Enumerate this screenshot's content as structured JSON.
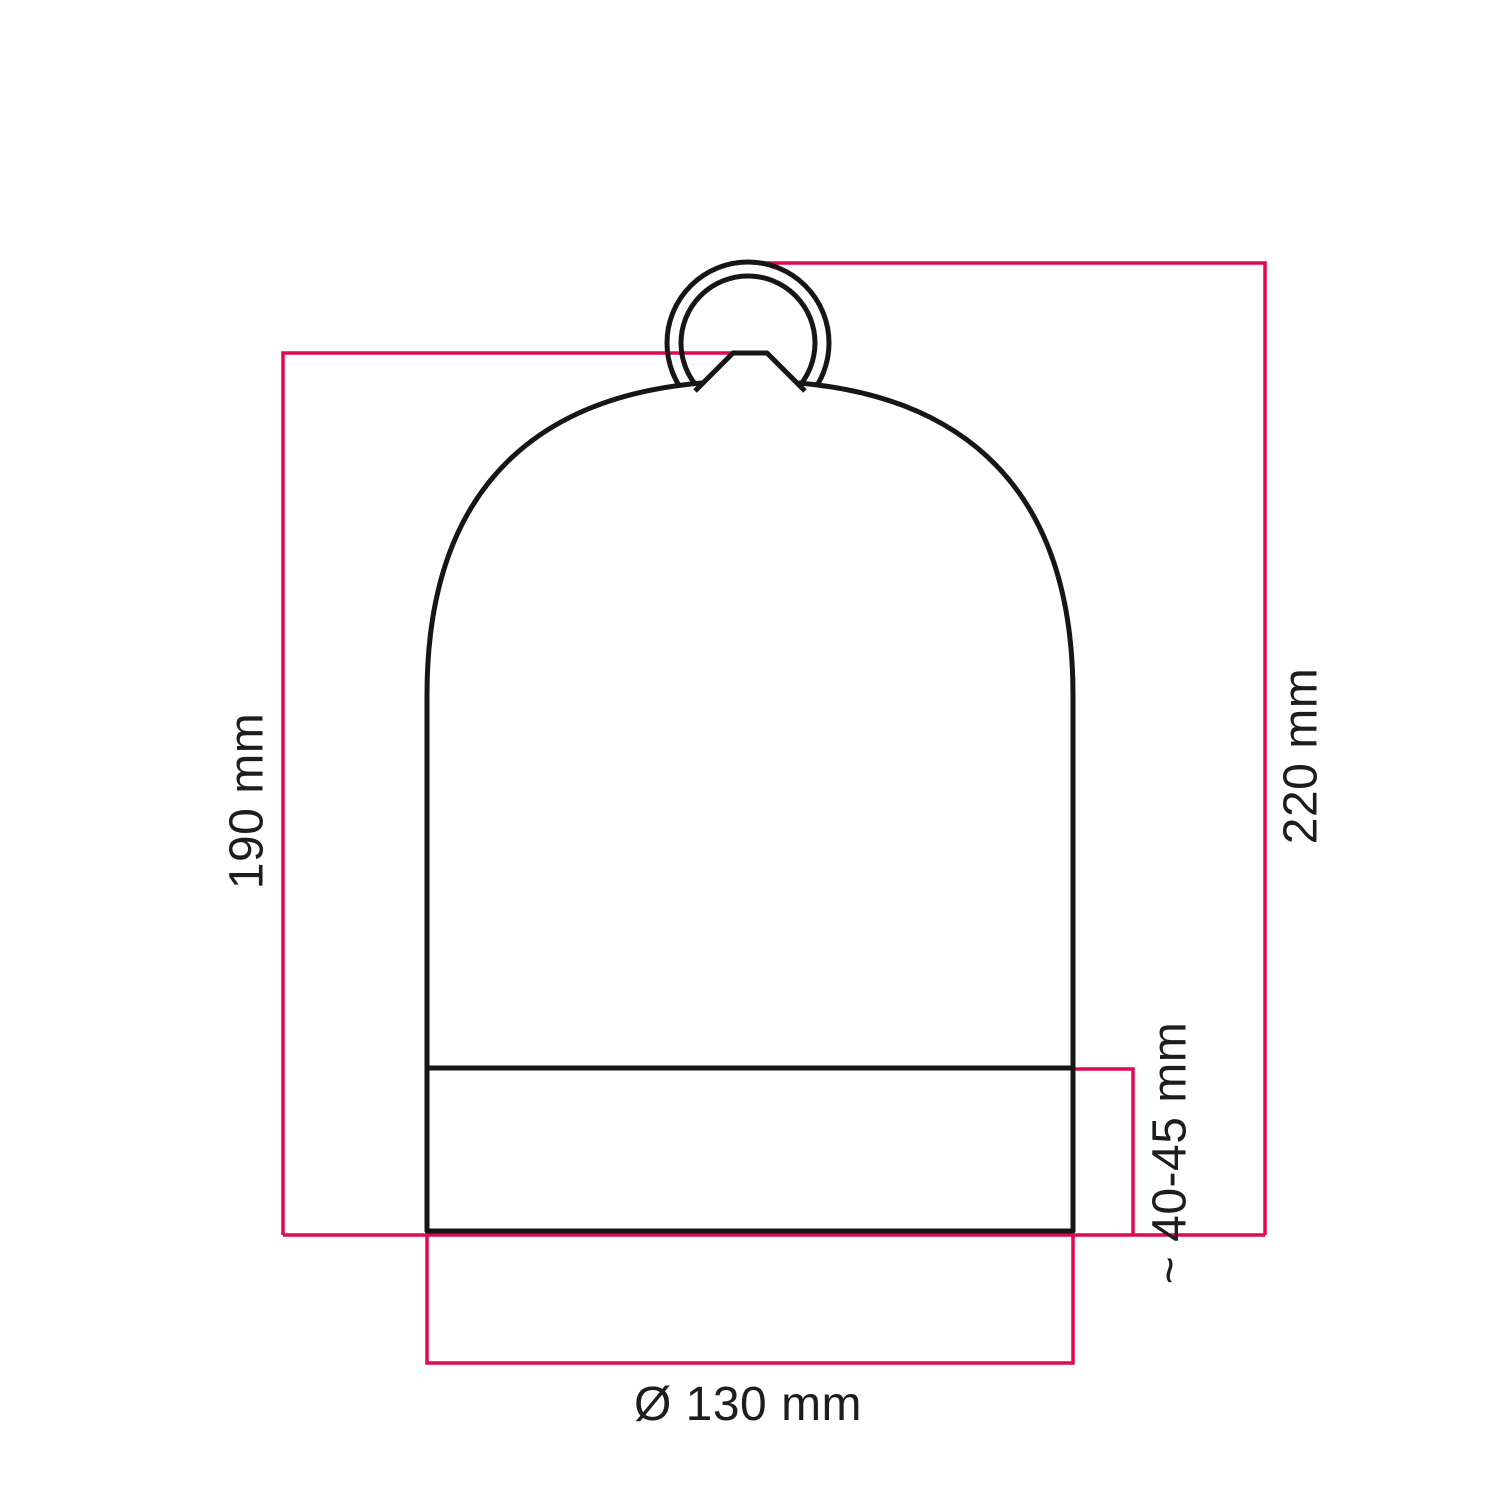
{
  "colors": {
    "accent": "#e0094f",
    "outline": "#161616",
    "text": "#1d1d1b",
    "background": "#ffffff"
  },
  "dimensions": [
    {
      "id": "shade-height-without-ring",
      "label": "190 mm"
    },
    {
      "id": "total-height-with-ring",
      "label": "220 mm"
    },
    {
      "id": "base-collar-height",
      "label": "~ 40-45 mm"
    },
    {
      "id": "shade-diameter",
      "label": "Ø 130 mm"
    }
  ]
}
